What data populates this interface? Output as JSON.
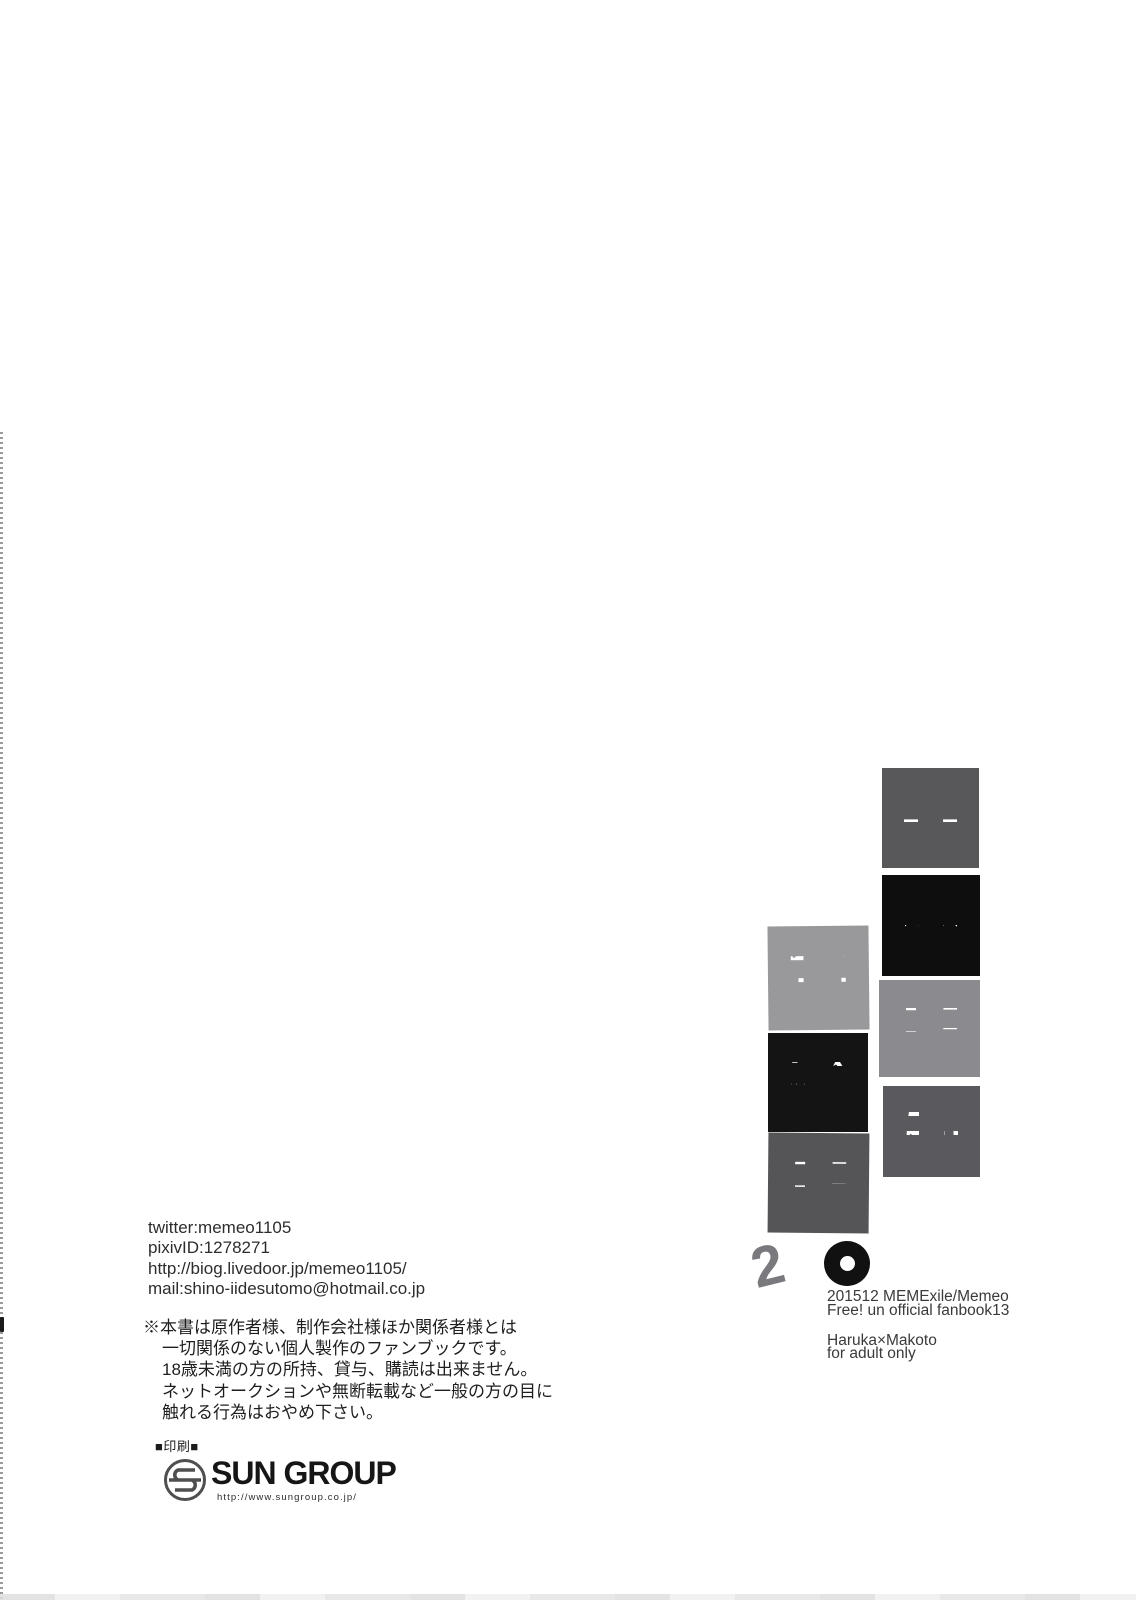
{
  "title": {
    "full_text": "思春期は適齢期2。",
    "right_column": [
      {
        "char": "思",
        "color": "#58575a"
      },
      {
        "char": "春",
        "color": "#0e0e0e"
      },
      {
        "char": "期",
        "color": "#8b8a8e"
      },
      {
        "char": "は",
        "color": "#5a595d"
      }
    ],
    "left_column": [
      {
        "char": "適",
        "color": "#99989b"
      },
      {
        "char": "齢",
        "color": "#141414"
      },
      {
        "char": "期",
        "color": "#555457"
      }
    ],
    "volume": {
      "char": "2",
      "color": "#7a797d"
    },
    "period": {
      "char": "。",
      "color": "#111111"
    }
  },
  "contact": {
    "lines": [
      "twitter:memeo1105",
      "pixivID:1278271",
      "http://biog.livedoor.jp/memeo1105/",
      "mail:shino-iidesutomo@hotmail.co.jp"
    ]
  },
  "disclaimer": {
    "lines": [
      "※本書は原作者様、制作会社様ほか関係者様とは",
      "一切関係のない個人製作のファンブックです。",
      "18歳未満の方の所持、貸与、購読は出来ません。",
      "ネットオークションや無断転載など一般の方の目に",
      "触れる行為はおやめ下さい。"
    ]
  },
  "credits": {
    "circle_date": "201512 MEMExile/Memeo",
    "fanbook": "Free! un official fanbook13",
    "pairing": "Haruka×Makoto",
    "rating": "for adult only"
  },
  "printer": {
    "label": "■印刷■",
    "name": "SUN GROUP",
    "url": "http://www.sungroup.co.jp/"
  },
  "colors": {
    "paper": "#ffffff",
    "logo_gray": "#4f4f4f"
  }
}
